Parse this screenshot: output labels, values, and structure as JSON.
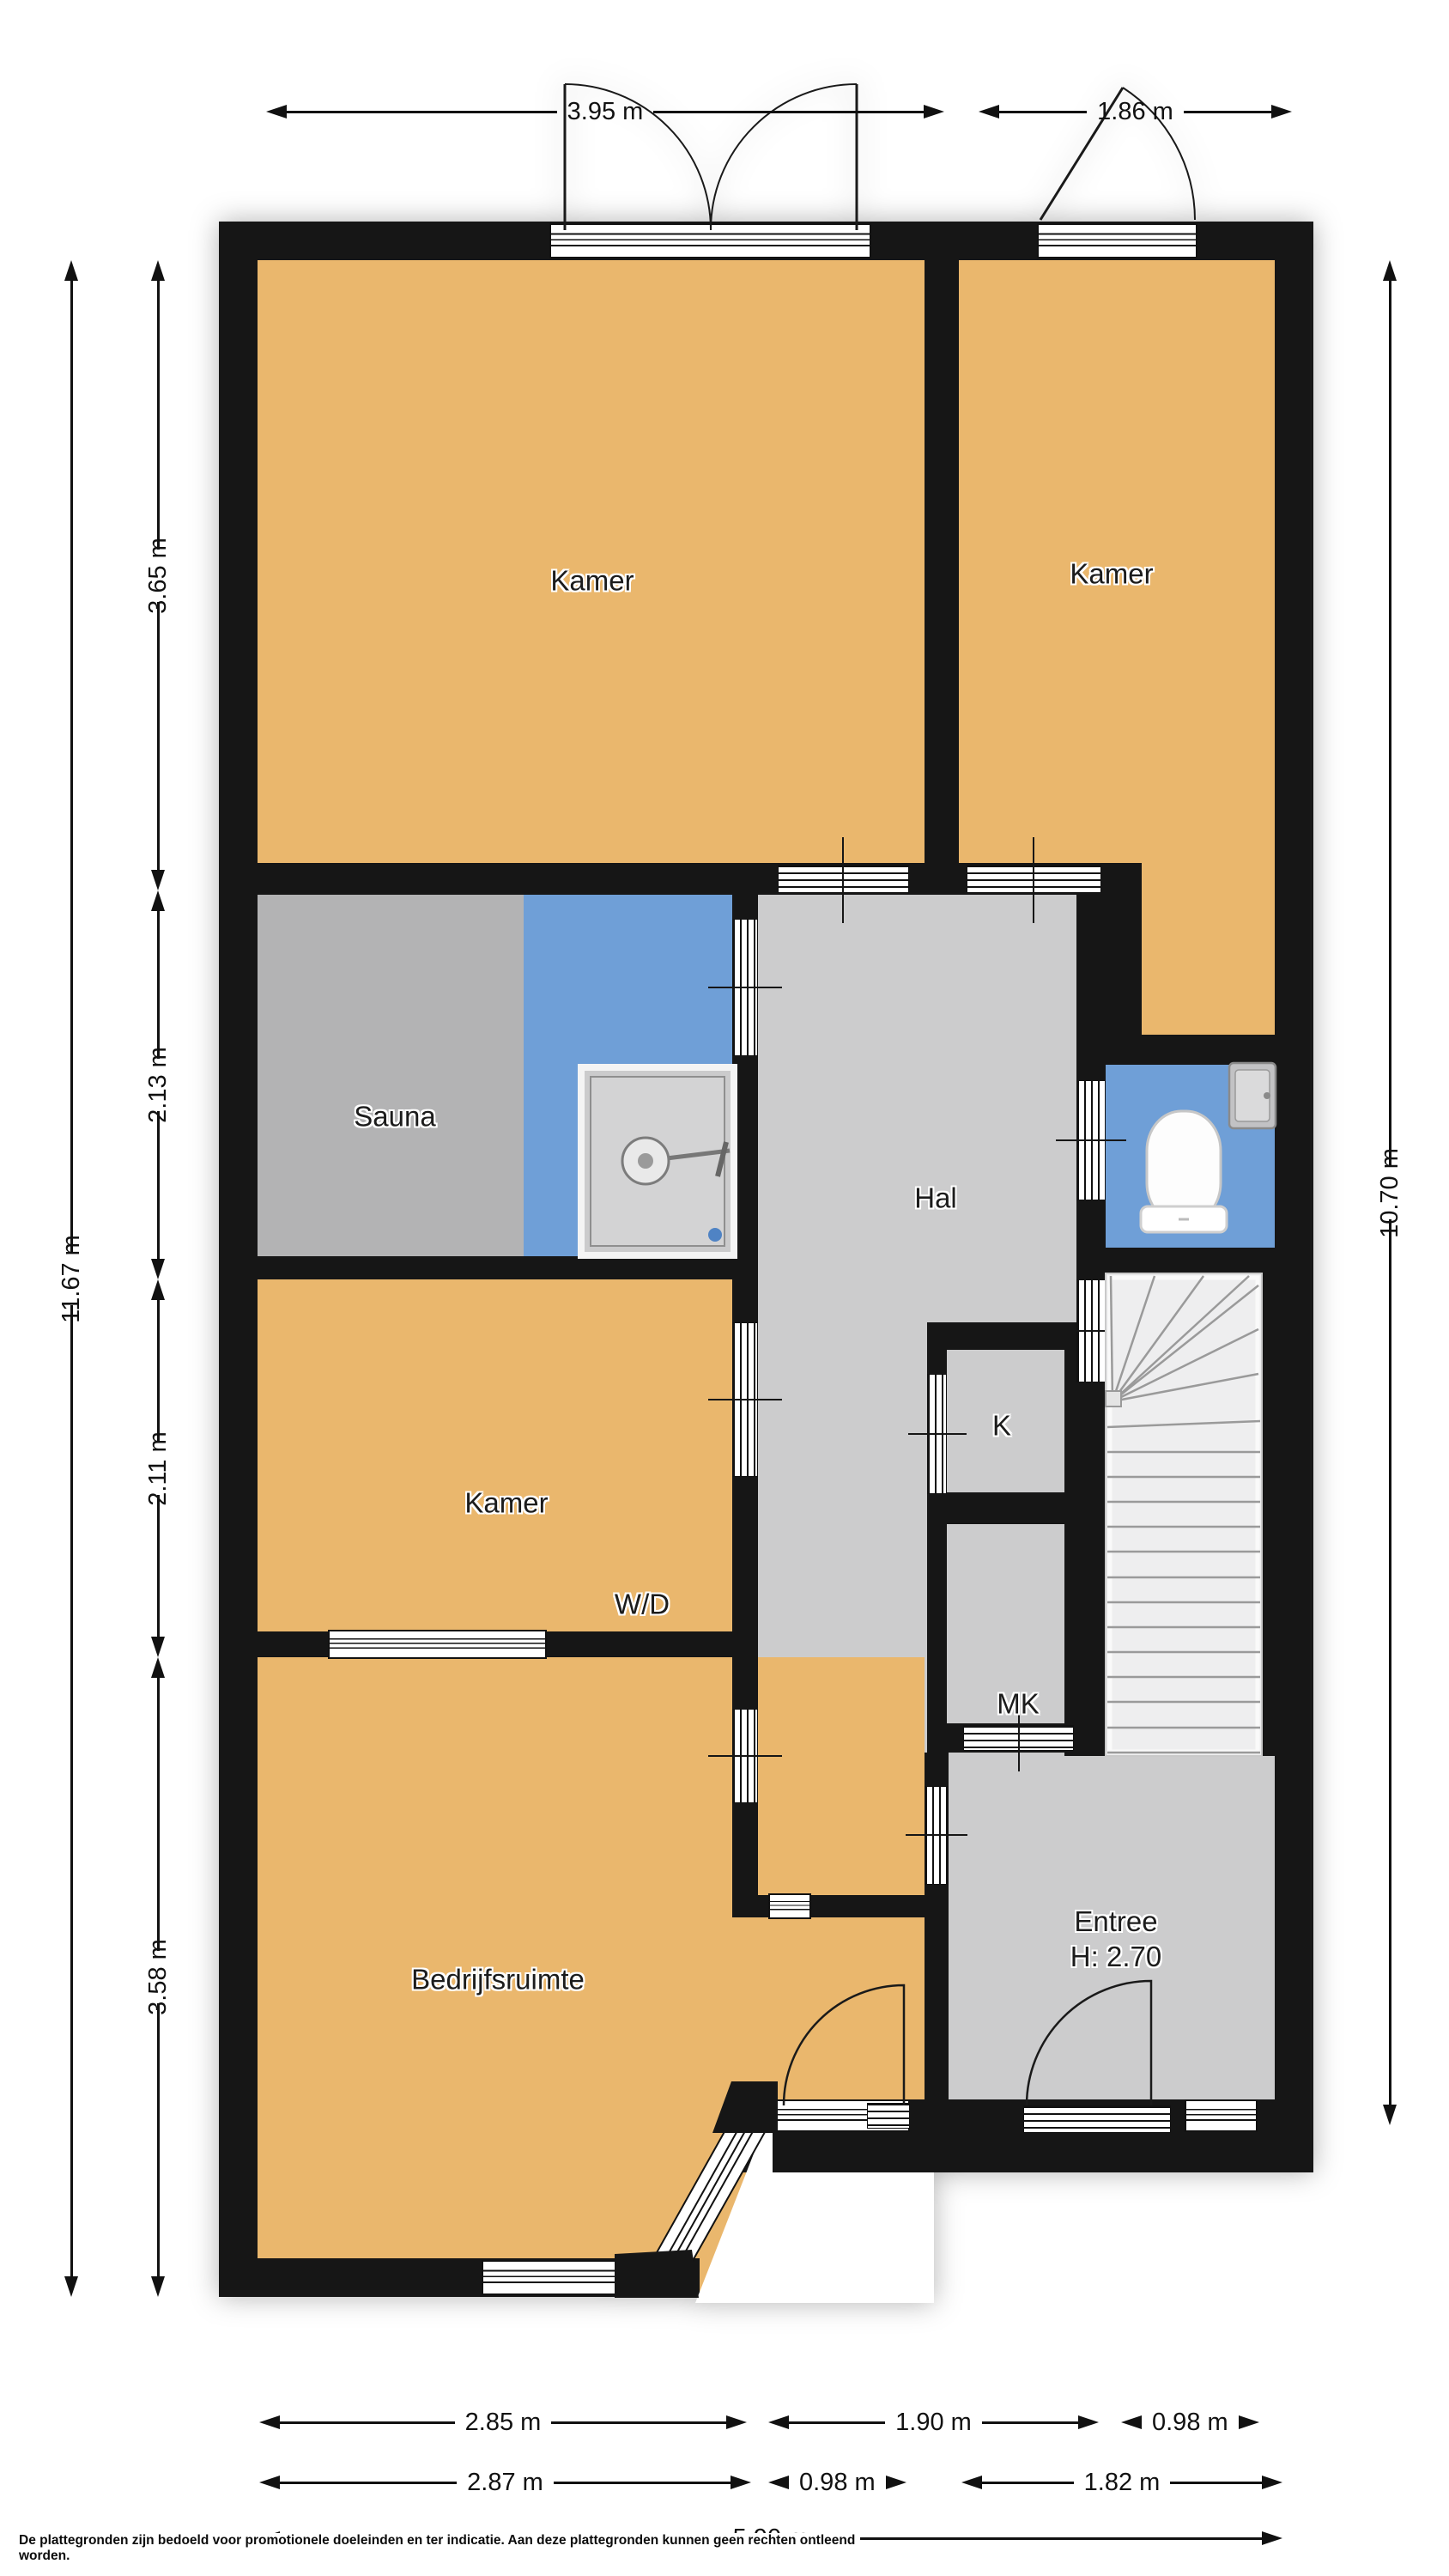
{
  "rooms": {
    "kamer_top_left": "Kamer",
    "kamer_top_right": "Kamer",
    "sauna": "Sauna",
    "hal": "Hal",
    "kamer_middle": "Kamer",
    "wd": "W/D",
    "k": "K",
    "mk": "MK",
    "bedrijfsruimte": "Bedrijfsruimte",
    "entree": "Entree",
    "entree_height": "H: 2.70"
  },
  "dimensions": {
    "top": [
      "3.95 m",
      "1.86 m"
    ],
    "left_total": "11.67 m",
    "left_segments": [
      "3.65 m",
      "2.13 m",
      "2.11 m",
      "3.58 m"
    ],
    "right_total": "10.70 m",
    "bottom_row1": [
      "2.85 m",
      "1.90 m",
      "0.98 m"
    ],
    "bottom_row2": [
      "2.87 m",
      "0.98 m",
      "1.82 m"
    ],
    "bottom_total": "5.90 m"
  },
  "footer": {
    "disclaimer": "De plattegronden zijn bedoeld voor promotionele doeleinden en ter indicatie. Aan deze plattegronden kunnen geen rechten ontleend worden."
  },
  "colors": {
    "room_orange": "#eab76d",
    "wet_area_blue": "#6f9fd7",
    "sauna_gray": "#b3b3b4",
    "floor_gray": "#cccccd",
    "wall_black": "#161616",
    "stairs_gray": "#eeeeef"
  }
}
